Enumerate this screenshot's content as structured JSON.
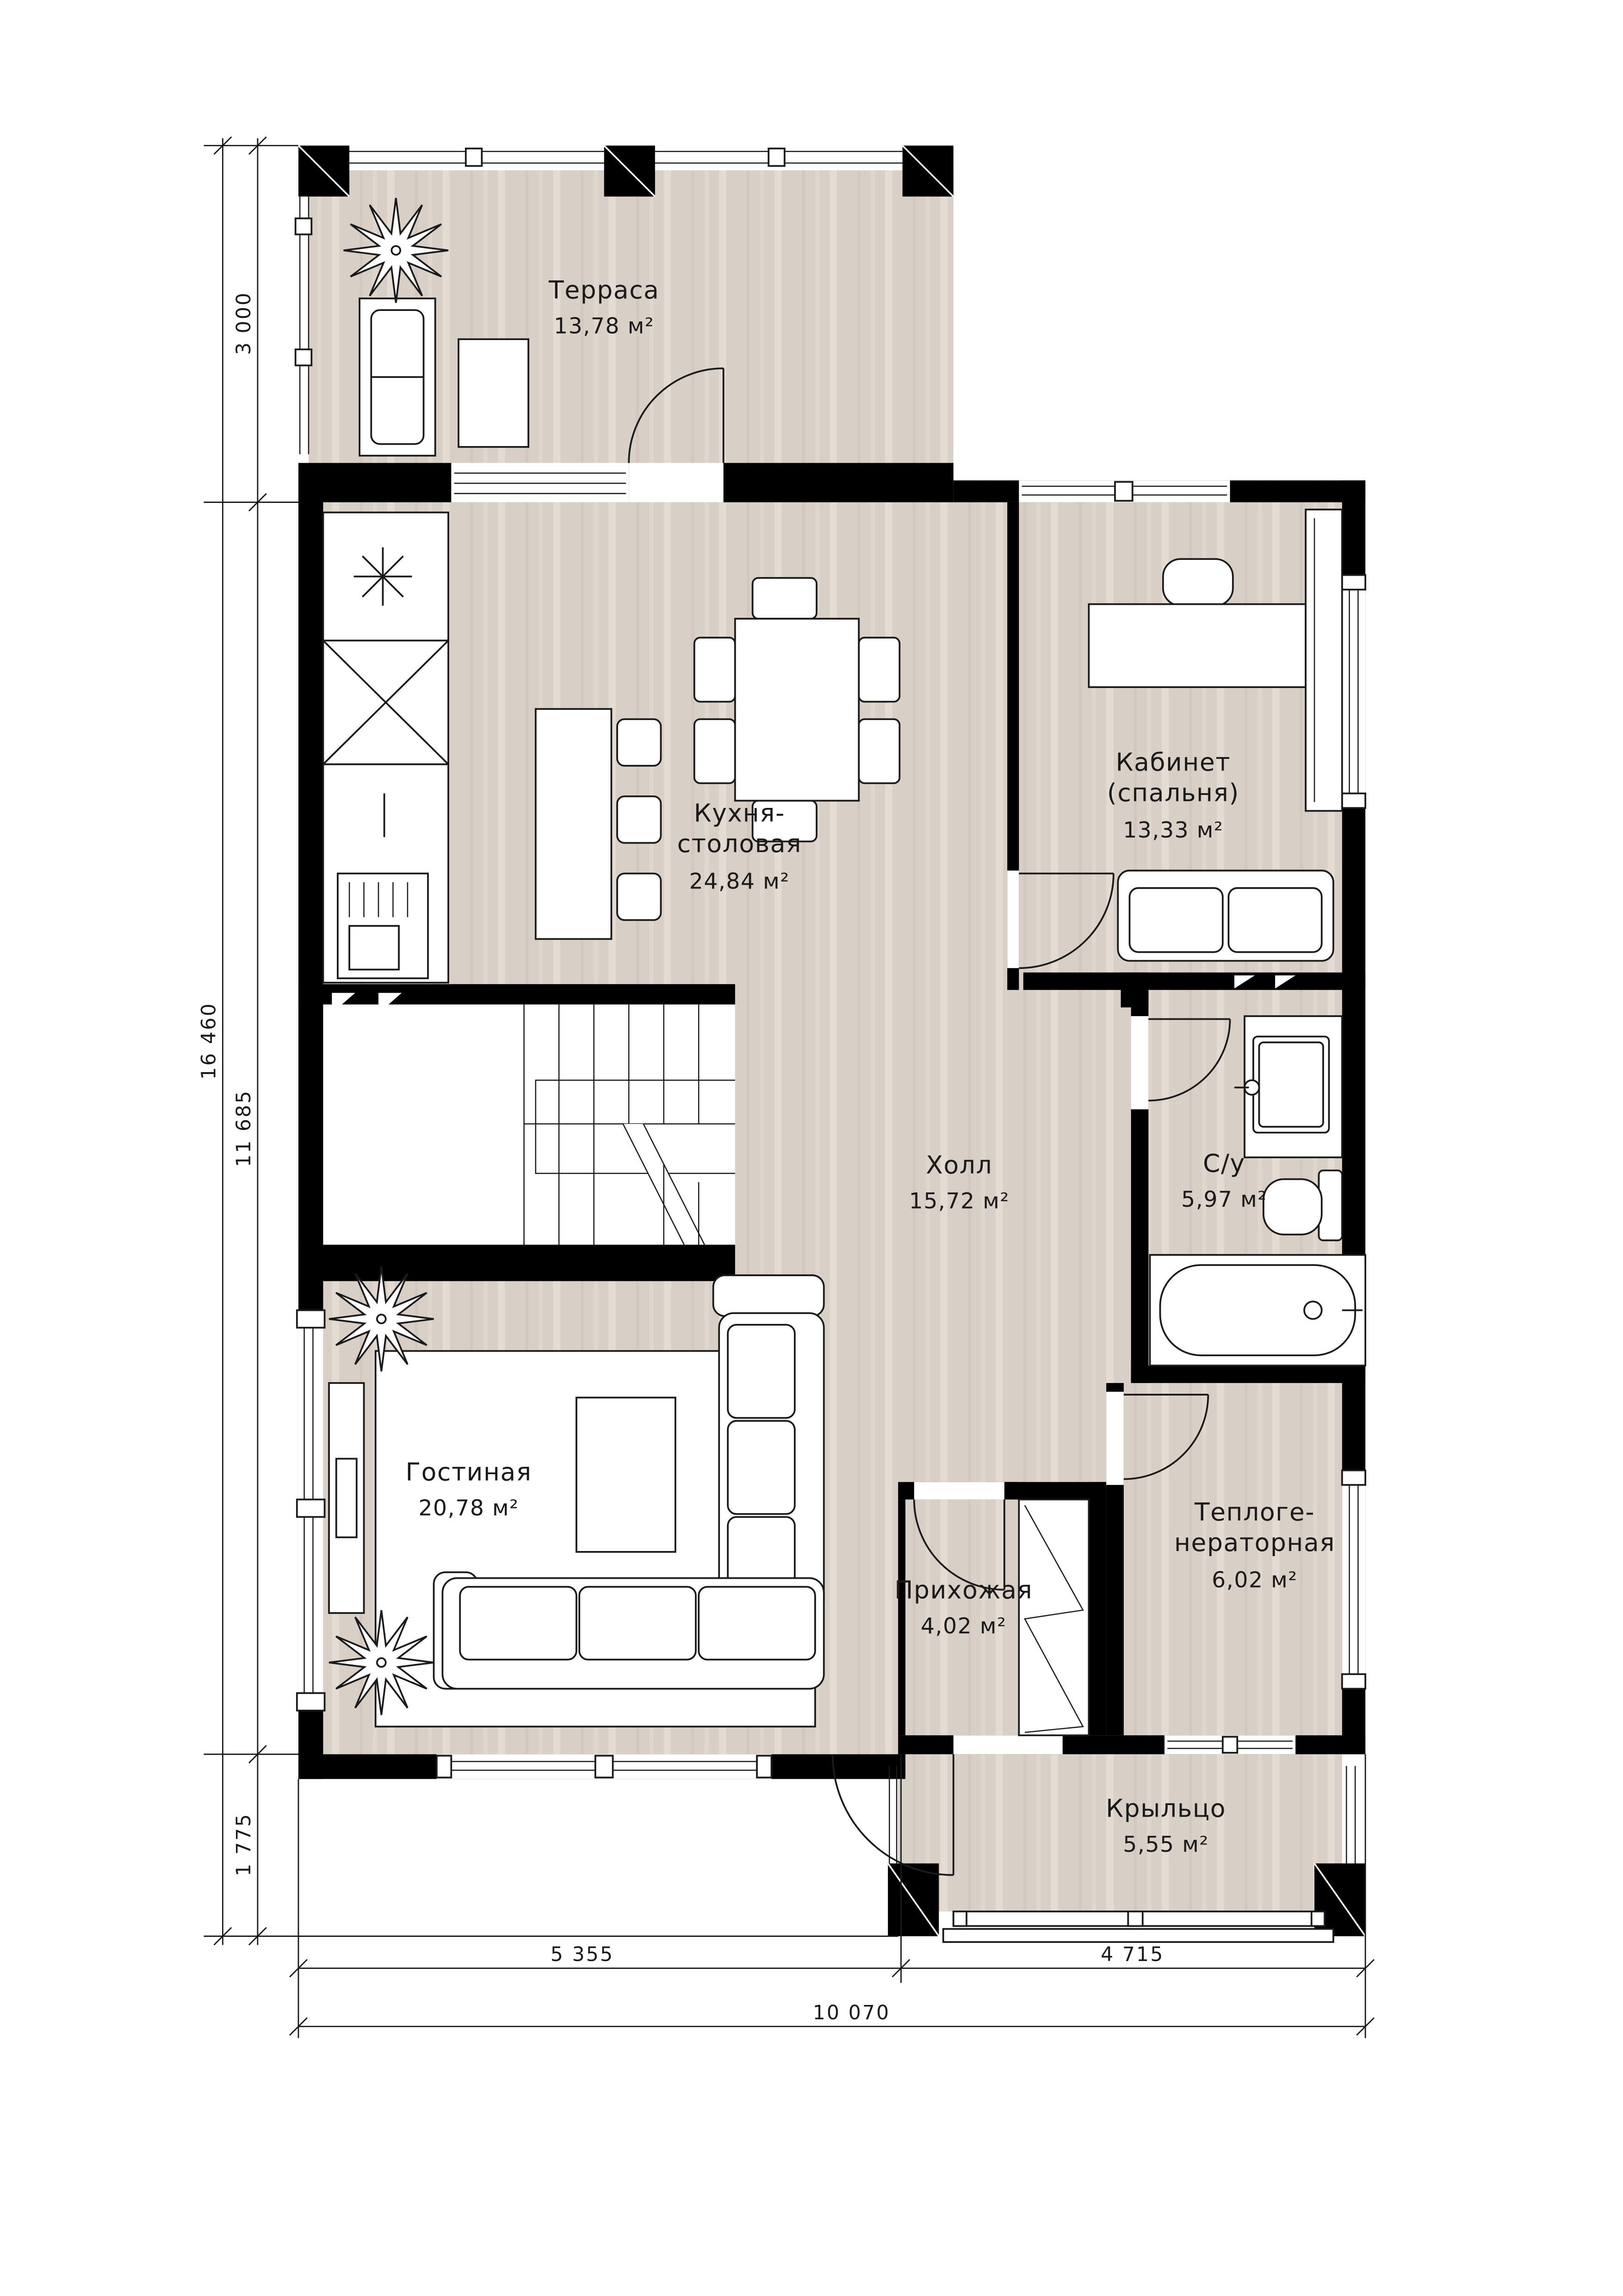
{
  "plan_type": "floor-plan",
  "rooms": {
    "terrace": {
      "name": "Терраса",
      "area": "13,78 м²"
    },
    "kitchen": {
      "line1": "Кухня-",
      "line2": "столовая",
      "area": "24,84 м²"
    },
    "study": {
      "line1": "Кабинет",
      "line2": "(спальня)",
      "area": "13,33 м²"
    },
    "hall": {
      "name": "Холл",
      "area": "15,72 м²"
    },
    "bathroom": {
      "name": "С/у",
      "area": "5,97 м²"
    },
    "living": {
      "name": "Гостиная",
      "area": "20,78 м²"
    },
    "entry": {
      "name": "Прихожая",
      "area": "4,02 м²"
    },
    "boiler": {
      "line1": "Теплоге-",
      "line2": "нераторная",
      "area": "6,02 м²"
    },
    "porch": {
      "name": "Крыльцо",
      "area": "5,55 м²"
    }
  },
  "dimensions": {
    "left_total": "16 460",
    "left_top": "3 000",
    "left_middle": "11 685",
    "left_bottom": "1 775",
    "bottom_left": "5 355",
    "bottom_right": "4 715",
    "bottom_total": "10 070"
  },
  "colors": {
    "floor": "#d8cfc6",
    "floor_light": "#e4dcd3",
    "floor_dark": "#cdc3b9",
    "wall": "#000000",
    "line": "#1a1a1a"
  }
}
